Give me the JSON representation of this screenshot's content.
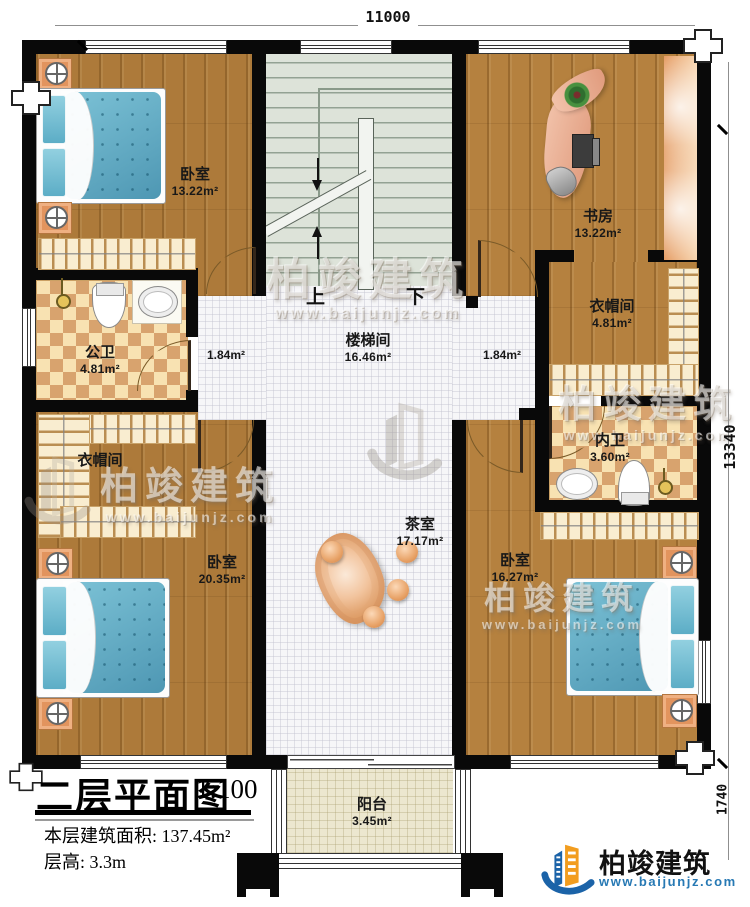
{
  "plan": {
    "title": "二层平面图",
    "scale": "1:100",
    "area_label": "本层建筑面积:",
    "area_value": "137.45m²",
    "floor_height_label": "层高:",
    "floor_height_value": "3.3m"
  },
  "dimensions": {
    "top_width": "11000",
    "right_height": "13340",
    "balcony_depth": "1740"
  },
  "rooms": {
    "bedroom_top_left": {
      "name": "卧室",
      "area": "13.22m²"
    },
    "study": {
      "name": "书房",
      "area": "13.22m²"
    },
    "stair_hall": {
      "name": "楼梯间",
      "area": "16.46m²"
    },
    "corridor_left": {
      "area": "1.84m²"
    },
    "corridor_right": {
      "area": "1.84m²"
    },
    "public_bathroom": {
      "name": "公卫",
      "area": "4.81m²"
    },
    "closet_left": {
      "name": "衣帽间"
    },
    "closet_right": {
      "name": "衣帽间",
      "area": "4.81m²"
    },
    "private_bathroom": {
      "name": "内卫",
      "area": "3.60m²"
    },
    "tea_room": {
      "name": "茶室",
      "area": "17.17m²"
    },
    "bedroom_bottom_left": {
      "name": "卧室",
      "area": "20.35m²"
    },
    "bedroom_bottom_right": {
      "name": "卧室",
      "area": "16.27m²"
    },
    "balcony": {
      "name": "阳台",
      "area": "3.45m²"
    }
  },
  "stairs": {
    "up": "上",
    "down": "下"
  },
  "watermark": {
    "name": "柏竣建筑",
    "url": "www.baijunjz.com"
  },
  "logo": {
    "name": "柏竣建筑",
    "url": "www.baijunjz.com"
  },
  "colors": {
    "wall": "#090909",
    "wood": "#ad7a3a",
    "checker_dark": "#d8a36e",
    "hall": "#f6f6f8",
    "stairs": "#dde3d9",
    "balcony": "#ece7cf",
    "accent_orange": "#f29d1f",
    "accent_blue": "#1b63a8"
  }
}
